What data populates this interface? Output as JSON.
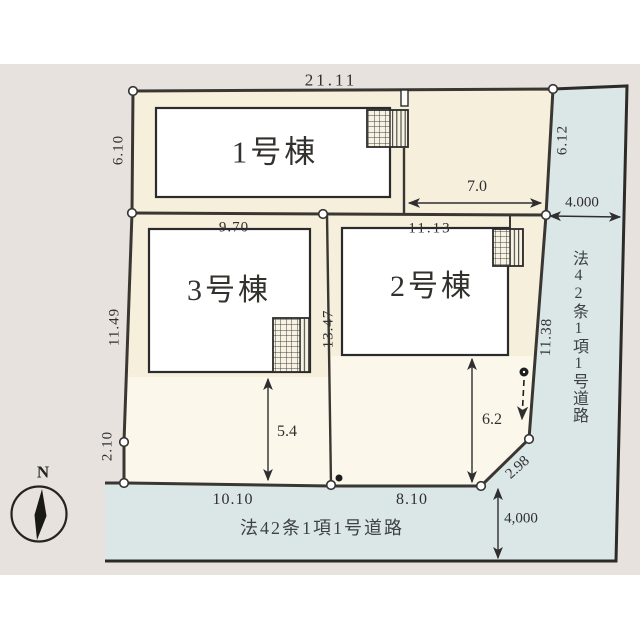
{
  "site_plan": {
    "buildings": [
      {
        "label": "1号棟"
      },
      {
        "label": "2号棟"
      },
      {
        "label": "3号棟"
      }
    ],
    "dimensions": {
      "top_width": "21.11",
      "left_upper": "6.10",
      "building3_width": "9.70",
      "building2_width": "11.13",
      "upper_right_lot_width": "7.0",
      "right_upper": "6.12",
      "road_width_right": "4.000",
      "left_middle": "11.49",
      "lot_divider": "13.47",
      "right_lower": "11.38",
      "left_lower": "2.10",
      "yard_depth_lot3": "5.4",
      "yard_depth_lot2": "6.2",
      "corner_cut": "2.98",
      "bottom_left_width": "10.10",
      "bottom_right_width": "8.10",
      "road_width_bottom": "4,000"
    },
    "roads": {
      "right_label": "法42条1項1号道路",
      "bottom_label": "法42条1項1号道路"
    },
    "compass": {
      "label": "N"
    },
    "colors": {
      "background_gray": "#e7e2de",
      "lot_cream": "#f6efdc",
      "yard_light": "#fbf7eb",
      "road_blue": "#dbe6e7",
      "building_white": "#ffffff",
      "line_dark": "#2d2b28",
      "text_dark": "#2f2f2f"
    }
  }
}
